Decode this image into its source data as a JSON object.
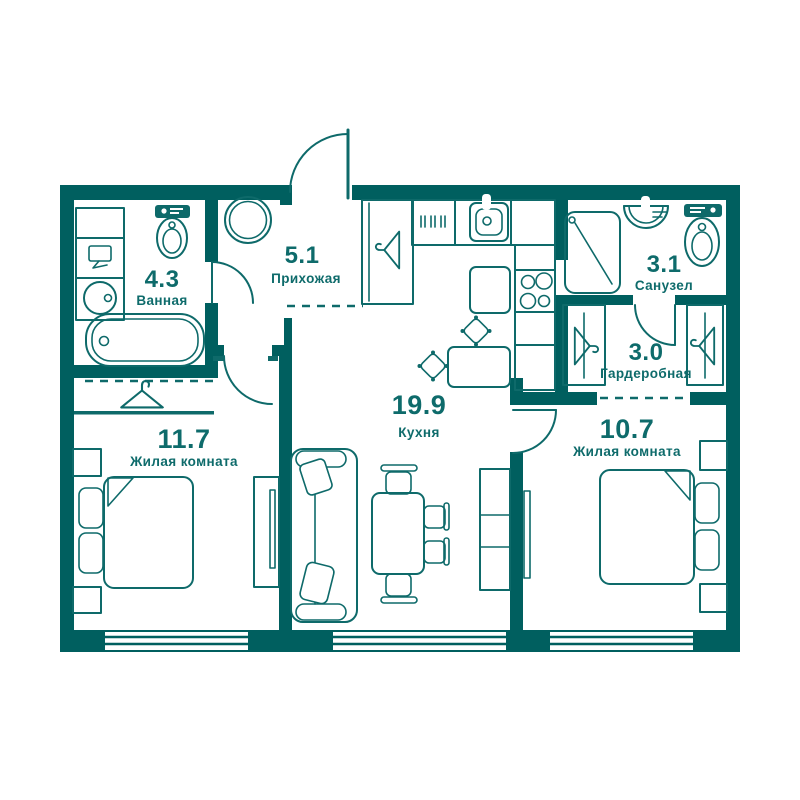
{
  "colors": {
    "wall": "#005f5f",
    "line": "#0e6a6a",
    "text": "#0e6b6b",
    "bg": "#ffffff"
  },
  "rooms": [
    {
      "area": "4.3",
      "name": "Ванная"
    },
    {
      "area": "5.1",
      "name": "Прихожая"
    },
    {
      "area": "3.1",
      "name": "Санузел"
    },
    {
      "area": "3.0",
      "name": "Гардеробная"
    },
    {
      "area": "11.7",
      "name": "Жилая комната"
    },
    {
      "area": "19.9",
      "name": "Кухня"
    },
    {
      "area": "10.7",
      "name": "Жилая комната"
    }
  ],
  "icons": [
    "toilet-icon",
    "bathtub-icon",
    "washing-machine-icon",
    "sink-icon",
    "shower-icon",
    "hanger-icon",
    "bed-icon",
    "sofa-icon",
    "dining-table-icon",
    "stove-icon",
    "kitchen-sink-icon",
    "round-table-icon",
    "tv-icon",
    "door-arc",
    "window"
  ]
}
